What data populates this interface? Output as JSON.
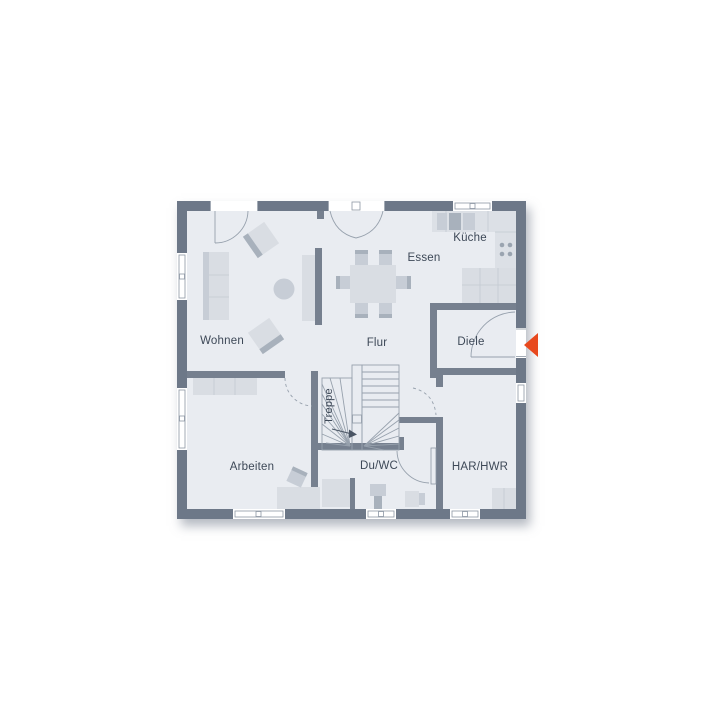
{
  "plan": {
    "rooms": [
      {
        "id": "wohnen",
        "label": "Wohnen"
      },
      {
        "id": "essen",
        "label": "Essen"
      },
      {
        "id": "kueche",
        "label": "Küche"
      },
      {
        "id": "flur",
        "label": "Flur"
      },
      {
        "id": "diele",
        "label": "Diele"
      },
      {
        "id": "arbeiten",
        "label": "Arbeiten"
      },
      {
        "id": "treppe",
        "label": "Treppe"
      },
      {
        "id": "duwc",
        "label": "Du/WC"
      },
      {
        "id": "harhwr",
        "label": "HAR/HWR"
      }
    ],
    "entrance_marker": {
      "icon": "entrance-arrow-icon",
      "direction": "left",
      "color": "#e8491e"
    },
    "colors": {
      "background": "#ffffff",
      "exterior_wall": "#6d7888",
      "interior_wall": "#76808f",
      "floor": "#e9ecf1",
      "stair_floor": "#f3f5f8",
      "furniture_light": "#d9dde3",
      "furniture_mid": "#c7cdd6",
      "furniture_dark": "#a8b1bc",
      "counter": "#dce0e6",
      "outline": "#97a1ad",
      "label_text": "#3d4857",
      "accent": "#e8491e"
    }
  }
}
